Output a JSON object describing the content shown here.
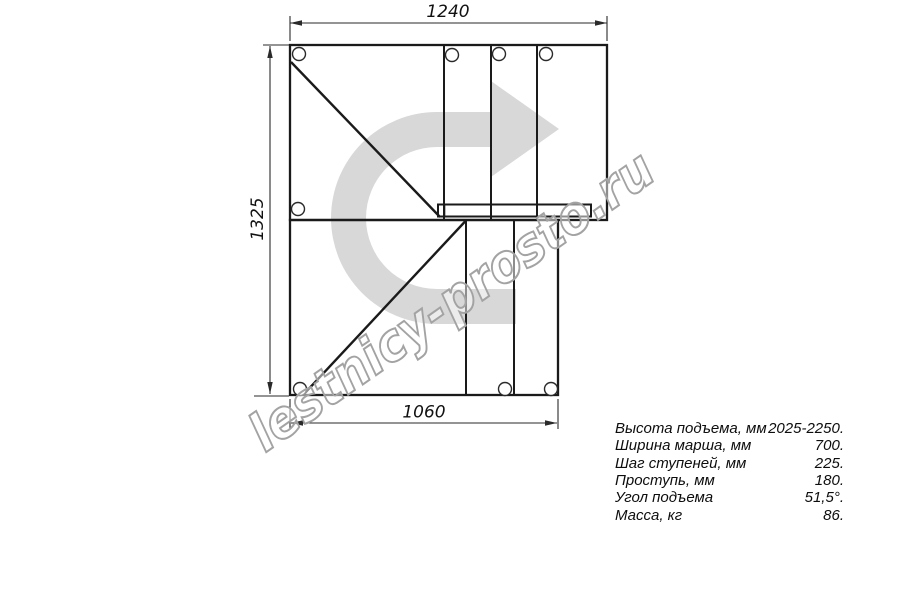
{
  "title": "Stair plan technical drawing",
  "watermark": {
    "text": "lestnicy-prosto.ru"
  },
  "drawing": {
    "type": "stair-plan-top-view-two-flights-90-turn",
    "dimensions": {
      "top": "1240",
      "left": "1325",
      "bottom": "1060"
    }
  },
  "specs": [
    {
      "label": "Высота подъема, мм",
      "value": "2025-2250."
    },
    {
      "label": "Ширина марша, мм",
      "value": "700."
    },
    {
      "label": "Шаг ступеней, мм",
      "value": "225."
    },
    {
      "label": "Проступь, мм",
      "value": "180."
    },
    {
      "label": "Угол подъема",
      "value": "51,5°."
    },
    {
      "label": "Масса, кг",
      "value": "86."
    }
  ],
  "colors": {
    "line": "#1a1a1a",
    "dimension_line": "#2a2a2a",
    "arrow_fill": "#d8d8d8",
    "watermark_stroke": "#a3a3a3",
    "background": "#ffffff"
  }
}
